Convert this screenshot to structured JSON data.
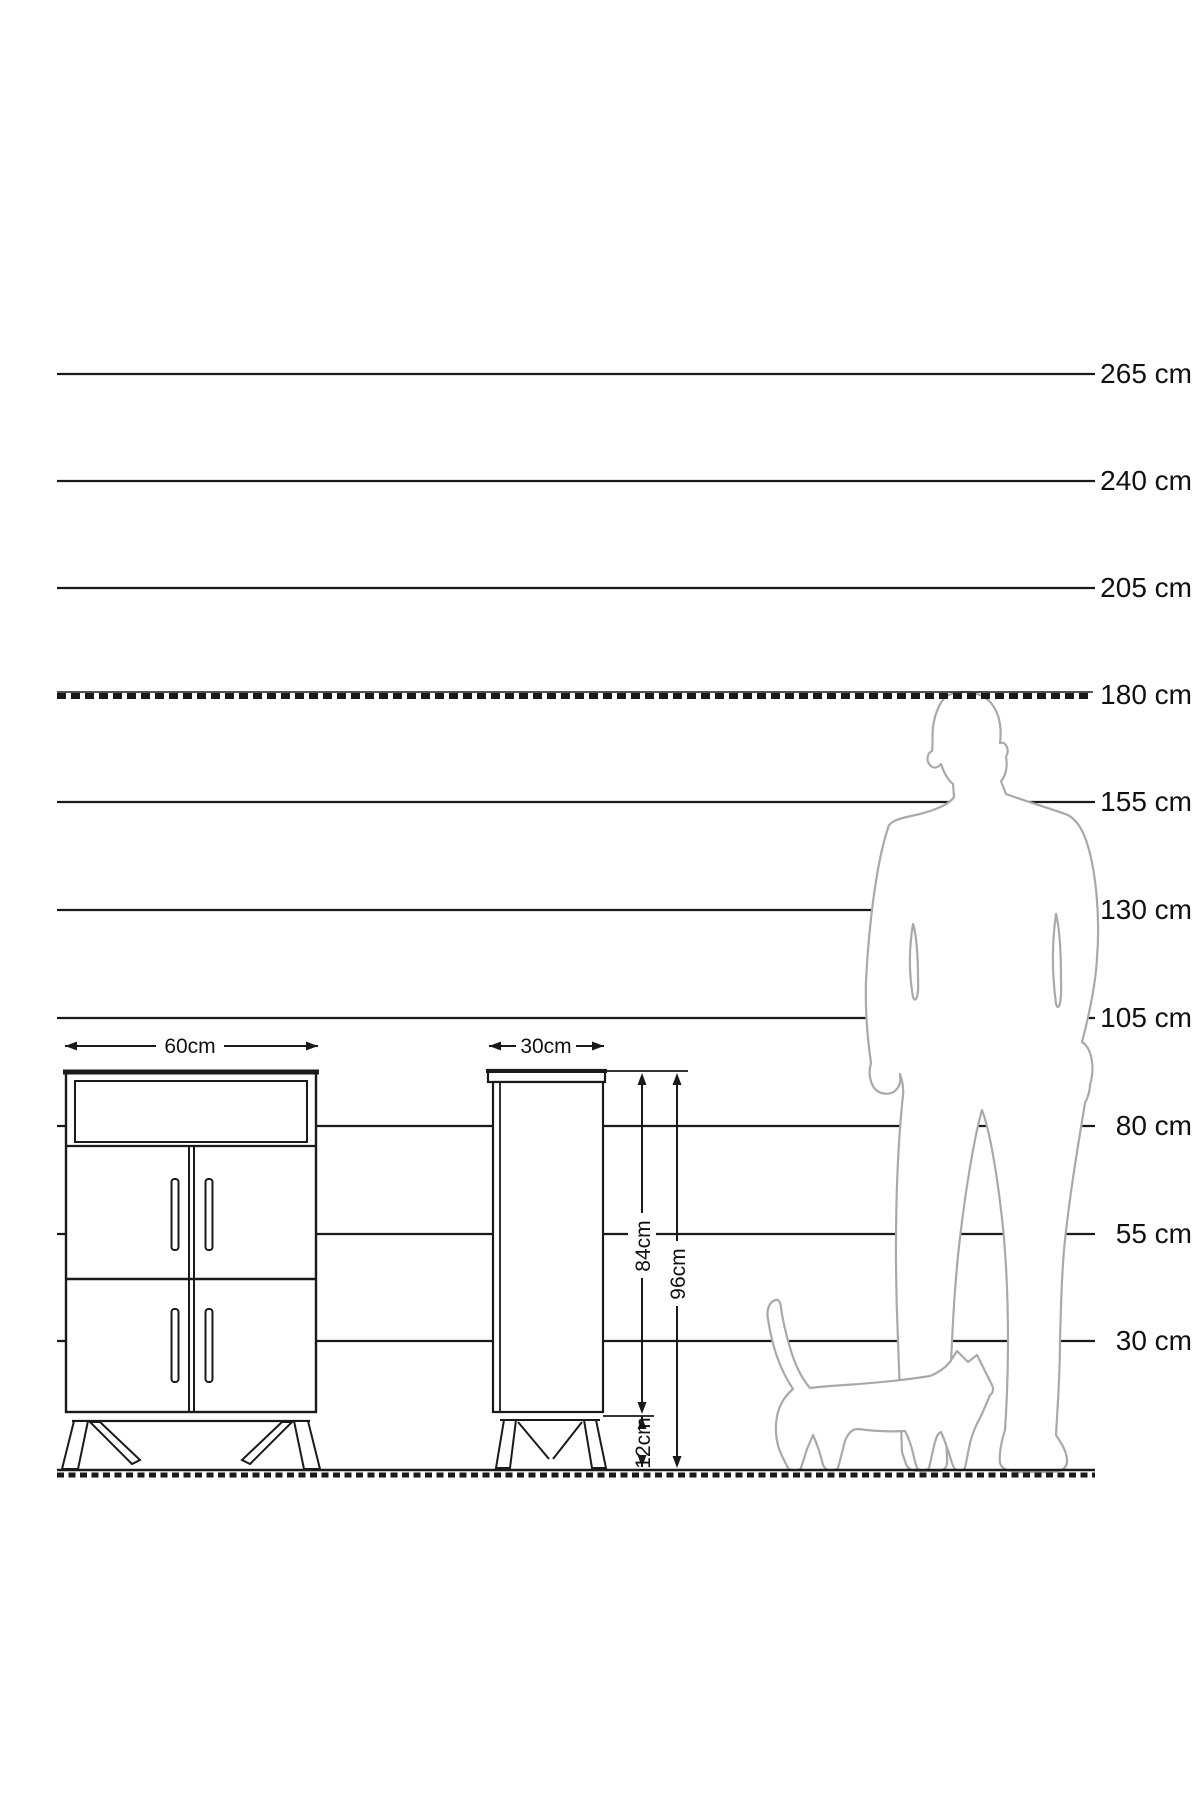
{
  "diagram": {
    "unit": "cm",
    "height_scale": {
      "labels": [
        "265 cm",
        "240 cm",
        "205 cm",
        "180 cm",
        "155 cm",
        "130 cm",
        "105 cm",
        "80 cm",
        "55 cm",
        "30 cm"
      ]
    },
    "cabinet_dimensions": {
      "front_width": "60cm",
      "side_depth": "30cm",
      "body_height": "84cm",
      "total_height": "96cm",
      "leg_height": "12cm"
    },
    "figures": {
      "man_icon": "man-silhouette",
      "cat_icon": "cat-silhouette"
    },
    "colors": {
      "ink": "#1a1a1a",
      "figure_outline": "#a9a9a9",
      "background": "#ffffff"
    }
  }
}
